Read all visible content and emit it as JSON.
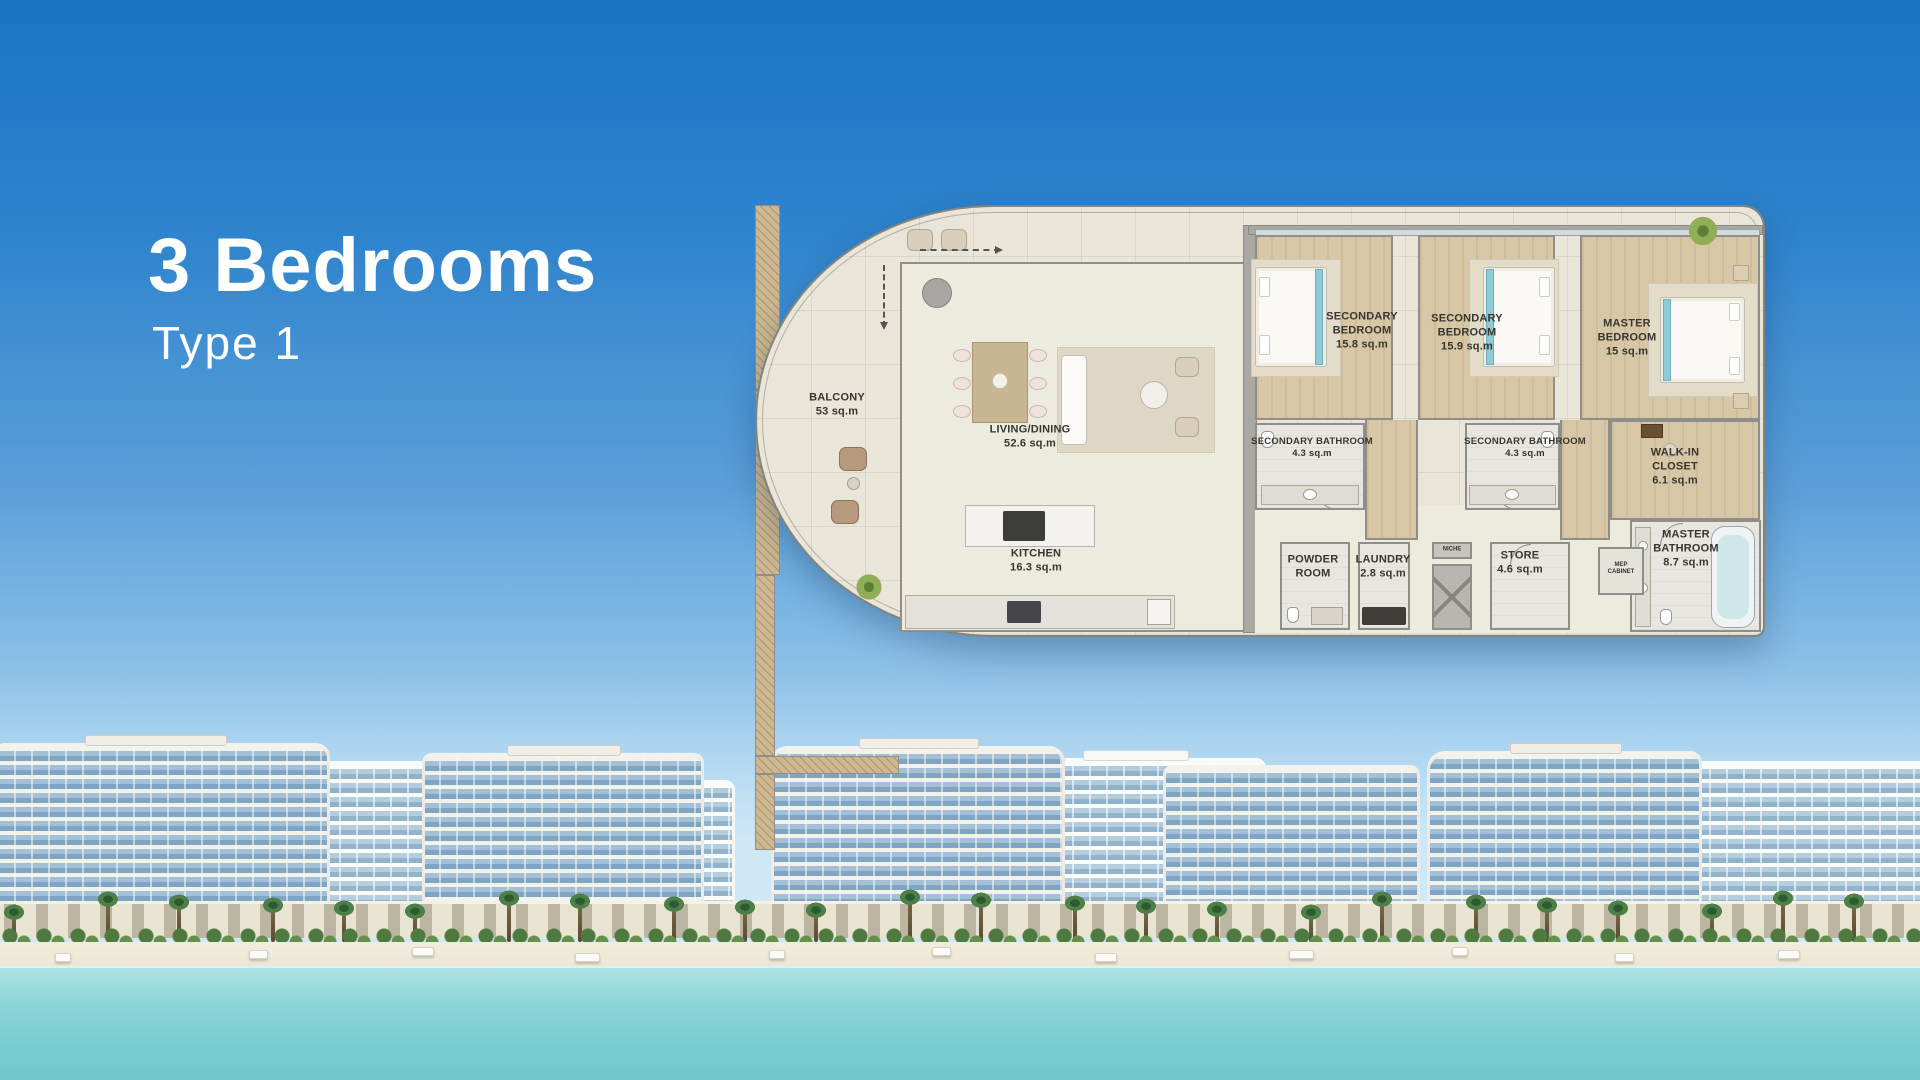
{
  "header": {
    "title": "3 Bedrooms",
    "subtitle": "Type 1"
  },
  "floor_plan": {
    "rooms": [
      {
        "name": "BALCONY",
        "area": "53 sq.m"
      },
      {
        "name": "LIVING/DINING",
        "area": "52.6 sq.m"
      },
      {
        "name": "KITCHEN",
        "area": "16.3 sq.m"
      },
      {
        "name": "SECONDARY BEDROOM",
        "area": "15.8 sq.m"
      },
      {
        "name": "SECONDARY BEDROOM",
        "area": "15.9 sq.m"
      },
      {
        "name": "MASTER BEDROOM",
        "area": "15 sq.m"
      },
      {
        "name": "SECONDARY BATHROOM",
        "area": "4.3 sq.m"
      },
      {
        "name": "SECONDARY BATHROOM",
        "area": "4.3 sq.m"
      },
      {
        "name": "WALK-IN CLOSET",
        "area": "6.1 sq.m"
      },
      {
        "name": "MASTER BATHROOM",
        "area": "8.7 sq.m"
      },
      {
        "name": "POWDER ROOM",
        "area": ""
      },
      {
        "name": "LAUNDRY",
        "area": "2.8 sq.m"
      },
      {
        "name": "STORE",
        "area": "4.6 sq.m"
      },
      {
        "name": "NICHE",
        "area": ""
      },
      {
        "name": "MEP CABINET",
        "area": ""
      }
    ]
  },
  "colors": {
    "sky_top": "#1a74c4",
    "sky_horizon": "#cfe8f7",
    "water": "#7acdd1",
    "sand": "#f2ecdd",
    "plan_floor": "#e9e5d8",
    "bedroom_floor": "#d8c7a6",
    "wall_gray": "#8f8e88",
    "accent_teal": "#8ecbd6",
    "title_text": "#ffffff"
  }
}
